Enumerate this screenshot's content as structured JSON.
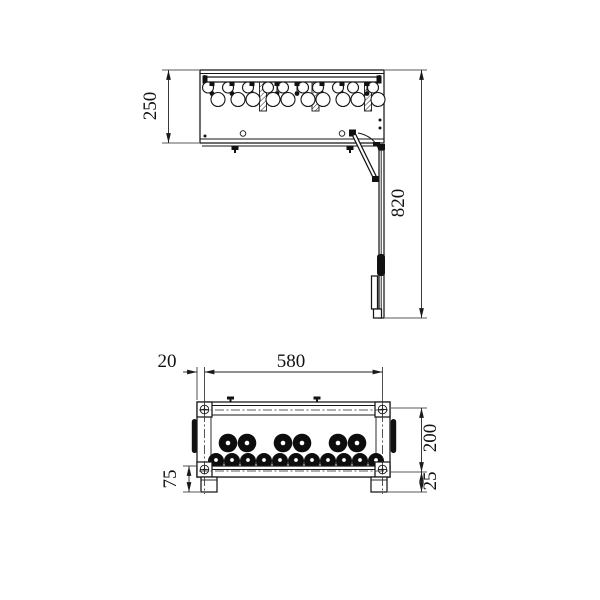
{
  "drawing": {
    "type": "technical-drawing-two-views",
    "dims": {
      "side_view_height": "250",
      "overall_height": "820",
      "edge_offset": "20",
      "width": "580",
      "front_height": "200",
      "foot_height": "25",
      "base_height": "75"
    }
  }
}
